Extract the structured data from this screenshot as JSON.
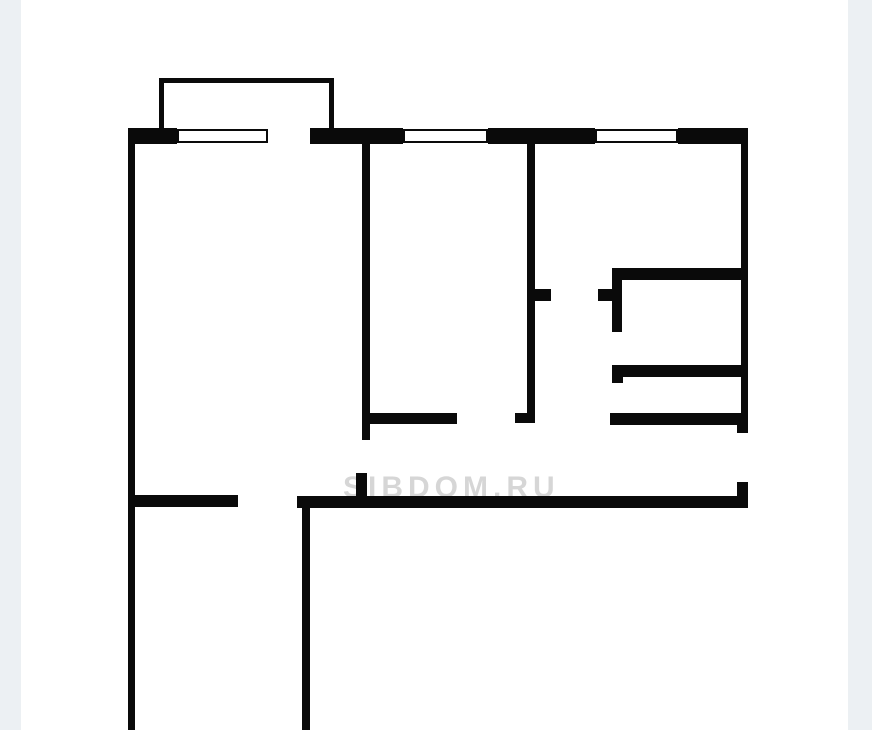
{
  "page": {
    "background_color": "#ffffff",
    "gutter_color": "#ecf0f3",
    "gutter_left_width": 21,
    "gutter_right_width": 24
  },
  "watermark": {
    "text": "SIBDOM.RU",
    "color": "rgba(0,0,0,0.16)"
  },
  "floorplan": {
    "type": "apartment-floor-plan",
    "wall_color": "#0a0a0a",
    "window_fill": "#ffffff",
    "walls": [
      {
        "name": "top-wall-seg-1",
        "x": 128,
        "y": 128,
        "w": 49,
        "h": 16
      },
      {
        "name": "top-wall-seg-2",
        "x": 310,
        "y": 128,
        "w": 93,
        "h": 16
      },
      {
        "name": "top-wall-seg-3",
        "x": 488,
        "y": 128,
        "w": 107,
        "h": 16
      },
      {
        "name": "top-wall-seg-4",
        "x": 678,
        "y": 128,
        "w": 70,
        "h": 16
      },
      {
        "name": "left-exterior-wall",
        "x": 128,
        "y": 144,
        "w": 7,
        "h": 586
      },
      {
        "name": "right-exterior-wall",
        "x": 741,
        "y": 144,
        "w": 7,
        "h": 276
      },
      {
        "name": "right-wall-foot",
        "x": 737,
        "y": 413,
        "w": 11,
        "h": 20
      },
      {
        "name": "balcony-top-wall",
        "x": 159,
        "y": 78,
        "w": 175,
        "h": 5
      },
      {
        "name": "balcony-left-wall",
        "x": 159,
        "y": 83,
        "w": 5,
        "h": 45
      },
      {
        "name": "balcony-right-wall",
        "x": 329,
        "y": 83,
        "w": 5,
        "h": 45
      },
      {
        "name": "bedroom-divider-wall",
        "x": 362,
        "y": 144,
        "w": 8,
        "h": 296
      },
      {
        "name": "corridor-north-wall-left",
        "x": 362,
        "y": 413,
        "w": 95,
        "h": 11
      },
      {
        "name": "left-room-door-jamb",
        "x": 356,
        "y": 473,
        "w": 11,
        "h": 25
      },
      {
        "name": "middle-divider-wall",
        "x": 527,
        "y": 144,
        "w": 8,
        "h": 278
      },
      {
        "name": "middle-divider-foot",
        "x": 515,
        "y": 413,
        "w": 20,
        "h": 10
      },
      {
        "name": "middle-divider-tick",
        "x": 535,
        "y": 289,
        "w": 16,
        "h": 12
      },
      {
        "name": "closet-top-wall",
        "x": 612,
        "y": 268,
        "w": 136,
        "h": 12
      },
      {
        "name": "closet-left-stub",
        "x": 612,
        "y": 280,
        "w": 10,
        "h": 52
      },
      {
        "name": "closet-stub-tick",
        "x": 598,
        "y": 289,
        "w": 14,
        "h": 12
      },
      {
        "name": "closet-mid-wall",
        "x": 612,
        "y": 365,
        "w": 136,
        "h": 12
      },
      {
        "name": "closet-mid-wall-foot",
        "x": 612,
        "y": 377,
        "w": 11,
        "h": 6
      },
      {
        "name": "closet-bottom-wall",
        "x": 610,
        "y": 413,
        "w": 138,
        "h": 12
      },
      {
        "name": "corridor-south-wall-left",
        "x": 130,
        "y": 495,
        "w": 108,
        "h": 12
      },
      {
        "name": "corridor-south-wall-right",
        "x": 297,
        "y": 496,
        "w": 451,
        "h": 12
      },
      {
        "name": "entry-door-jamb",
        "x": 737,
        "y": 482,
        "w": 11,
        "h": 16
      },
      {
        "name": "lower-room-right-wall",
        "x": 302,
        "y": 497,
        "w": 8,
        "h": 233
      }
    ],
    "windows": [
      {
        "name": "window-1",
        "x": 177,
        "y": 129,
        "w": 91,
        "h": 14
      },
      {
        "name": "window-2",
        "x": 403,
        "y": 129,
        "w": 85,
        "h": 14
      },
      {
        "name": "window-3",
        "x": 595,
        "y": 129,
        "w": 83,
        "h": 14
      }
    ]
  }
}
